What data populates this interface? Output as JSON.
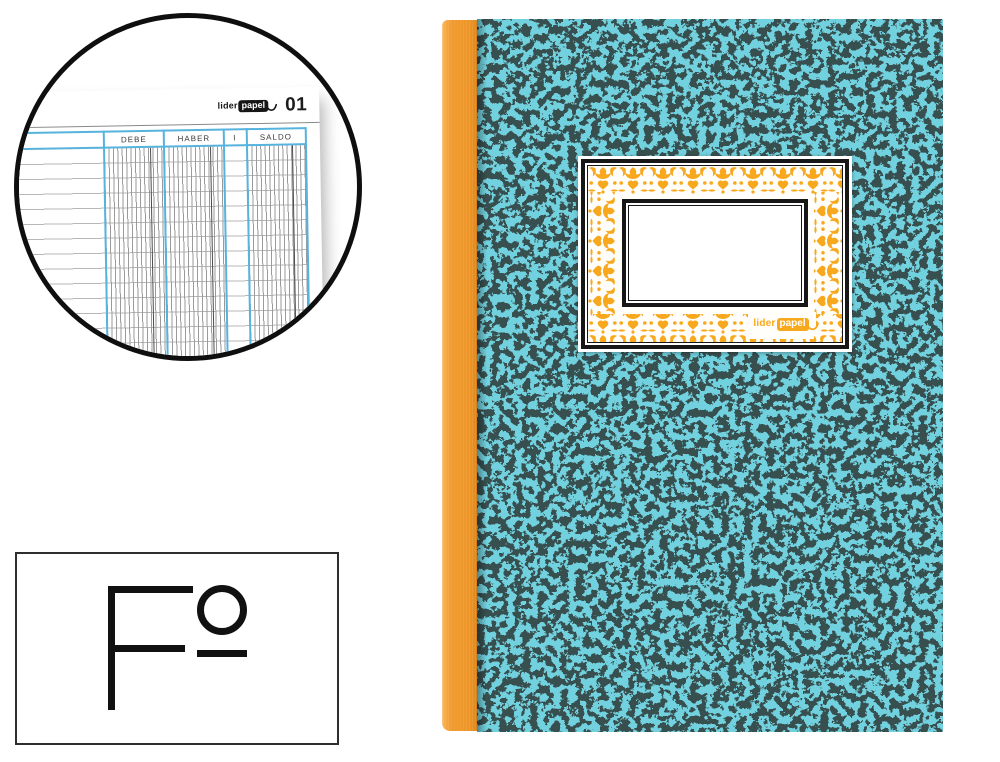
{
  "brand": {
    "prefix": "lider",
    "suffix": "papel"
  },
  "inset_detail": {
    "page_number": "01",
    "ledger_columns": [
      "DEBE",
      "HABER",
      "I",
      "SALDO"
    ]
  },
  "size_badge": {
    "text": "Fº"
  },
  "colors": {
    "cover_teal": "#2AA3BA",
    "cover_black": "#0B1413",
    "spine_orange": "#F09A2D",
    "ornament_yellow": "#F8A81C",
    "ledger_blue": "#56B3DE",
    "frame_black": "#171717"
  }
}
